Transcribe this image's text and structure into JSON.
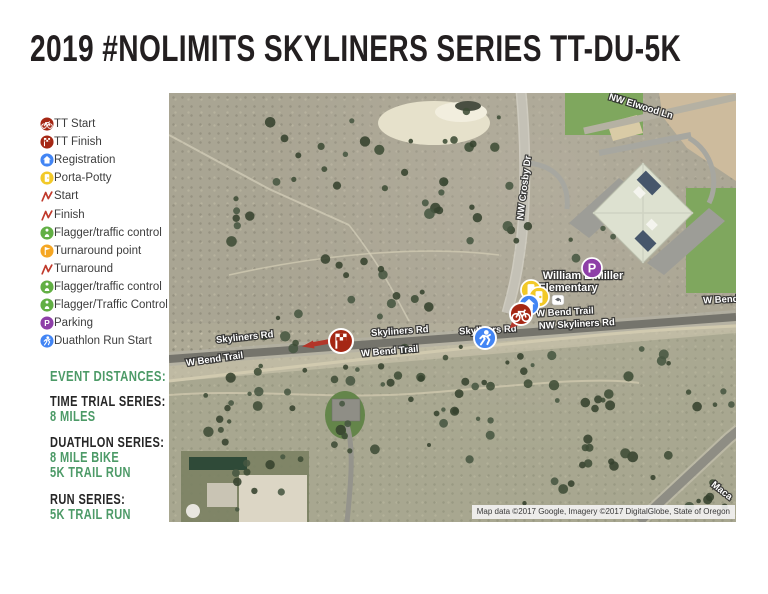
{
  "header": {
    "title": "2019 #NOLIMITS SKYLINERS SERIES TT-DU-5K",
    "subtitle": "START-FINISH"
  },
  "colors": {
    "accent_green": "#4c9a67",
    "marker_dark_red": "#A52714",
    "marker_blue": "#4285F4",
    "marker_yellow": "#F2C928",
    "marker_green": "#62AF44",
    "marker_orange": "#F5A623",
    "marker_purple": "#8E3FA8",
    "route_red": "#C0392B"
  },
  "legend": {
    "items": [
      {
        "icon": "bike-circle",
        "color": "#A52714",
        "label": "TT Start"
      },
      {
        "icon": "checkered-flag-circle",
        "color": "#A52714",
        "label": "TT Finish"
      },
      {
        "icon": "house-circle",
        "color": "#4285F4",
        "label": "Registration"
      },
      {
        "icon": "porta-potty-circle",
        "color": "#F2C928",
        "label": "Porta-Potty"
      },
      {
        "icon": "zigzag",
        "color": "#C0392B",
        "label": "Start"
      },
      {
        "icon": "zigzag",
        "color": "#C0392B",
        "label": "Finish"
      },
      {
        "icon": "person-circle",
        "color": "#62AF44",
        "label": "Flagger/traffic control"
      },
      {
        "icon": "flag-circle",
        "color": "#F5A623",
        "label": "Turnaround point"
      },
      {
        "icon": "zigzag",
        "color": "#C0392B",
        "label": "Turnaround"
      },
      {
        "icon": "person-circle",
        "color": "#62AF44",
        "label": "Flagger/traffic control"
      },
      {
        "icon": "person-circle",
        "color": "#62AF44",
        "label": "Flagger/Traffic Control"
      },
      {
        "icon": "parking-circle",
        "color": "#8E3FA8",
        "label": "Parking"
      },
      {
        "icon": "runner-circle",
        "color": "#4285F4",
        "label": "Duathlon Run Start"
      }
    ]
  },
  "distances": {
    "heading": "EVENT DISTANCES:",
    "sections": [
      {
        "title": "TIME TRIAL SERIES:",
        "lines": [
          "8 MILES"
        ]
      },
      {
        "title": "DUATHLON SERIES:",
        "lines": [
          "8 MILE BIKE",
          "5K TRAIL RUN"
        ]
      },
      {
        "title": "RUN SERIES:",
        "lines": [
          "5K TRAIL RUN"
        ]
      }
    ]
  },
  "map": {
    "place_labels": [
      {
        "text": "William E Miller",
        "x": 414,
        "y": 186,
        "size": 11
      },
      {
        "text": "Elementary",
        "x": 399,
        "y": 198,
        "size": 11
      }
    ],
    "road_labels": [
      {
        "text": "NW Elwood Ln",
        "x": 471,
        "y": 16,
        "rotate": 17
      },
      {
        "text": "NW Crosby Dr",
        "x": 358,
        "y": 95,
        "rotate": -83
      },
      {
        "text": "Skyliners Rd",
        "x": 76,
        "y": 247,
        "rotate": -6
      },
      {
        "text": "Skyliners Rd",
        "x": 231,
        "y": 241,
        "rotate": -4
      },
      {
        "text": "Skyliners Rd",
        "x": 319,
        "y": 240,
        "rotate": -3
      },
      {
        "text": "NW Skyliners Rd",
        "x": 408,
        "y": 234,
        "rotate": -3
      },
      {
        "text": "W Bend Trail",
        "x": 46,
        "y": 269,
        "rotate": -8
      },
      {
        "text": "W Bend Trail",
        "x": 221,
        "y": 261,
        "rotate": -5
      },
      {
        "text": "W Bend Trail",
        "x": 396,
        "y": 222,
        "rotate": -3
      },
      {
        "text": "W Bend Trail",
        "x": 563,
        "y": 209,
        "rotate": -3
      },
      {
        "text": "Maca",
        "x": 551,
        "y": 400,
        "rotate": 38
      }
    ],
    "markers": [
      {
        "name": "parking-marker",
        "icon": "parking-circle",
        "color": "#8E3FA8",
        "x": 423,
        "y": 175,
        "r": 10
      },
      {
        "name": "porta-potty-marker",
        "icon": "porta-potty-circle",
        "color": "#F2C928",
        "x": 362,
        "y": 197,
        "r": 10
      },
      {
        "name": "porta-potty-marker",
        "icon": "porta-potty-circle",
        "color": "#F2C928",
        "x": 370,
        "y": 204,
        "r": 10
      },
      {
        "name": "registration-marker",
        "icon": "house-circle",
        "color": "#4285F4",
        "x": 360,
        "y": 212,
        "r": 10
      },
      {
        "name": "tt-start-marker",
        "icon": "bike-circle",
        "color": "#A52714",
        "x": 352,
        "y": 221,
        "r": 11
      },
      {
        "name": "duathlon-run-start-marker",
        "icon": "runner-circle",
        "color": "#4285F4",
        "x": 316,
        "y": 245,
        "r": 11
      },
      {
        "name": "tt-finish-marker",
        "icon": "checkered-flag-circle",
        "color": "#A52714",
        "x": 172,
        "y": 248,
        "r": 12
      }
    ],
    "attribution": "Map data ©2017 Google, Imagery ©2017 DigitalGlobe, State of Oregon"
  }
}
